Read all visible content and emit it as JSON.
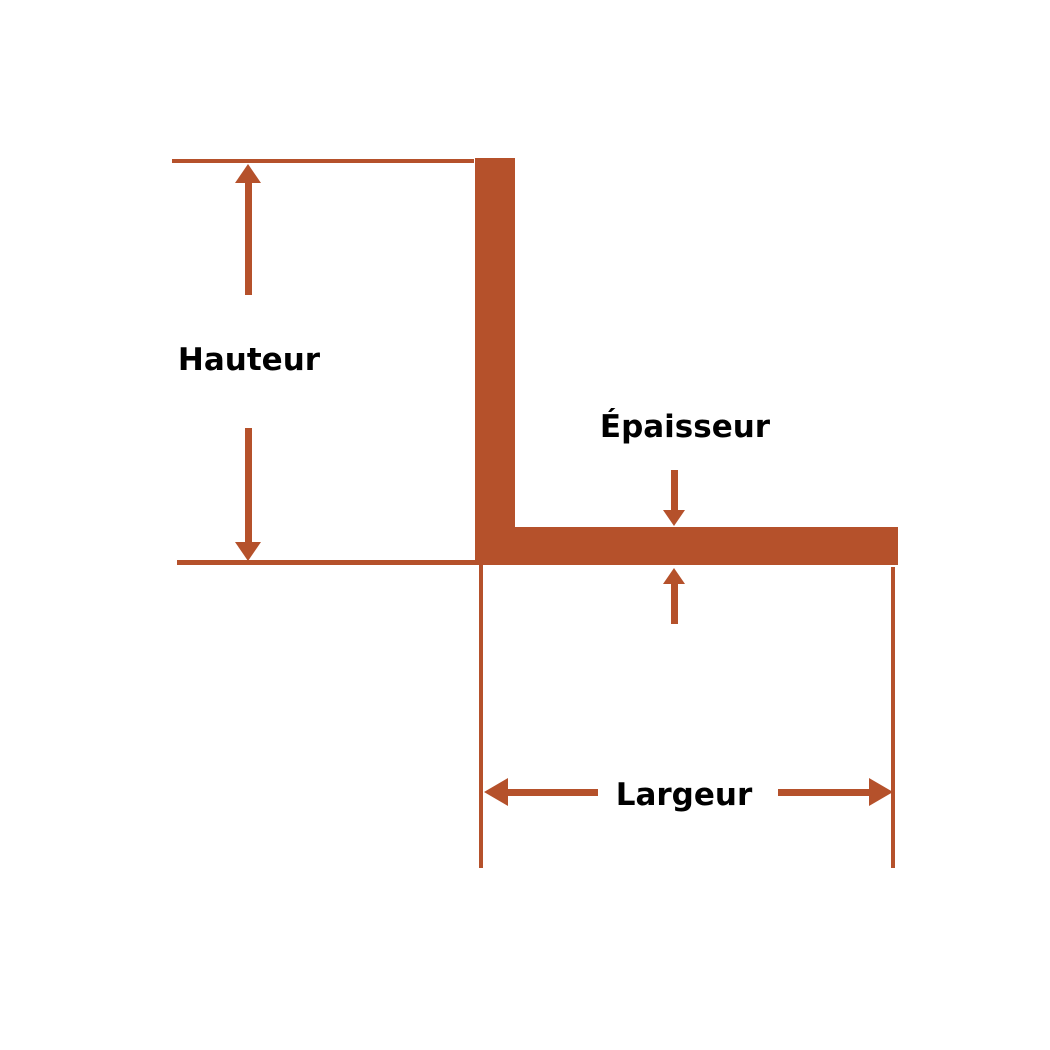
{
  "figure": "l-angle-profile-dimension-diagram",
  "labels": {
    "height": "Hauteur",
    "thickness": "Épaisseur",
    "width": "Largeur"
  },
  "colors": {
    "accent": "#b5512b",
    "label-text": "#000000",
    "background": "#ffffff"
  }
}
